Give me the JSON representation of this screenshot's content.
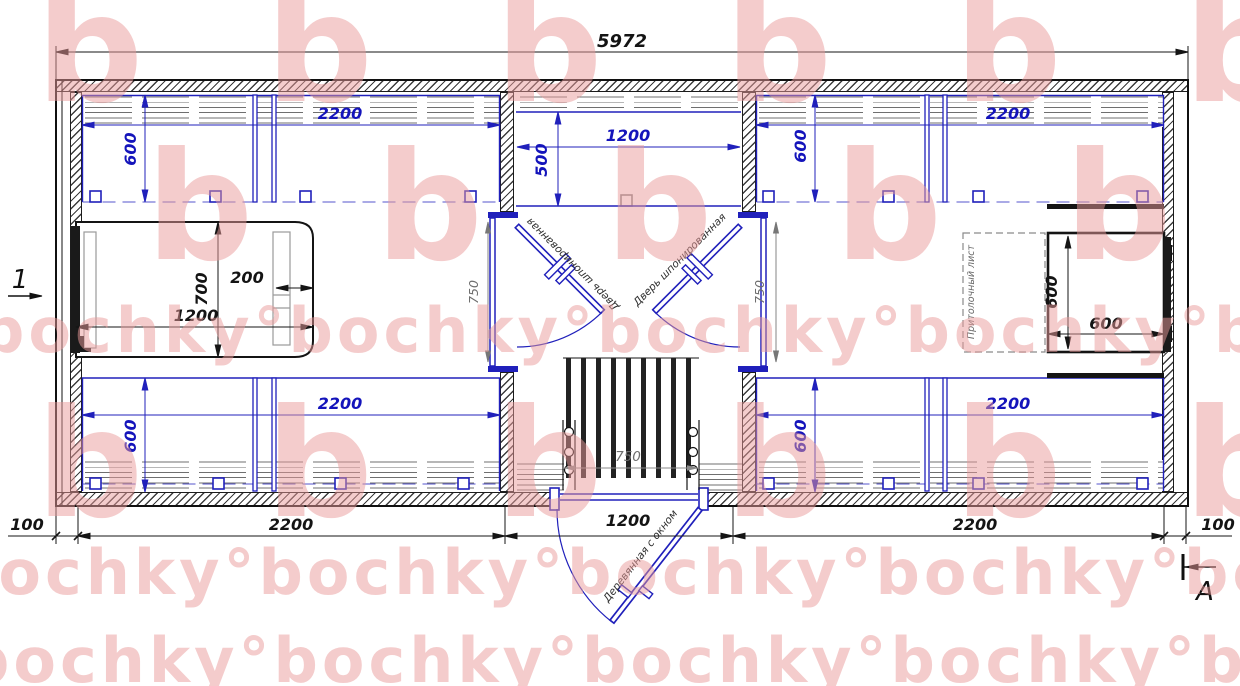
{
  "watermark": {
    "brand_word": "bochky",
    "letter_row": "b b b b b b",
    "text_row": "bochky°bochky°bochky°bochky°bochky°",
    "color": "#ea9a9a"
  },
  "dims": {
    "overall": "5972",
    "bunk_length": "2200",
    "bunk_depth": "600",
    "shelf_width": "1200",
    "shelf_depth": "500",
    "door_opening": "750",
    "grate_width": "750",
    "bed_length": "1200",
    "bed_width": "700",
    "bed_shelf": "200",
    "table_width": "600",
    "table_depth": "600",
    "bottom_row": [
      "100",
      "2200",
      "1200",
      "2200",
      "100"
    ]
  },
  "labels": {
    "door_left": "Дверь шпонированная",
    "door_right": "Дверь шпонированная",
    "entry_door": "Деревянная с окном",
    "ceiling_sheet": "Притолочный лист",
    "section_mark_1": "1",
    "section_mark_a": "А"
  }
}
